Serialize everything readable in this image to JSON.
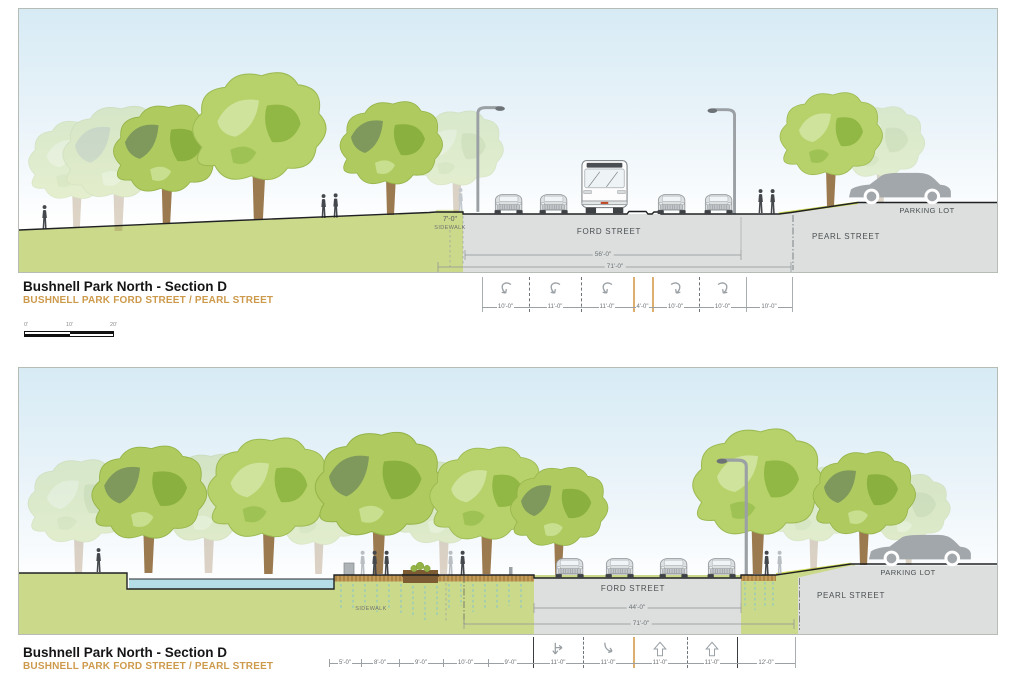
{
  "document": {
    "title": "Bushnell Park North - Section D",
    "subtitle": "BUSHNELL PARK FORD STREET / PEARL STREET"
  },
  "colors": {
    "sky_top": "#d7ebf5",
    "park_green": "#cbd98b",
    "road_gray": "#dcdfde",
    "water_blue": "#b5dde8",
    "soil_brown": "#c49a56",
    "subtitle_orange": "#cd9a4c",
    "lane_marker_orange": "#dcaf6e",
    "slope_highlight": "#cfd84f",
    "outline_dark": "#1f2123"
  },
  "scale_bar": {
    "labels": [
      "0'",
      "10'",
      "20'"
    ]
  },
  "sections": {
    "top": {
      "labels": {
        "sidewalk_width": "7'-0\"",
        "sidewalk": "SIDEWALK",
        "ford_street": "FORD STREET",
        "pearl_street": "PEARL STREET",
        "parking_lot": "PARKING LOT",
        "roadway_width": "56'-0\"",
        "overall_width": "71'-0\""
      },
      "lanes": [
        {
          "label": "10'-0\"",
          "arrow": "curl-left"
        },
        {
          "label": "11'-0\"",
          "arrow": "curl-left"
        },
        {
          "label": "11'-0\"",
          "arrow": "curl-left"
        },
        {
          "label": "4'-0\"",
          "arrow": null
        },
        {
          "label": "10'-0\"",
          "arrow": "curl-right"
        },
        {
          "label": "10'-0\"",
          "arrow": "curl-right"
        },
        {
          "label": "10'-0\"",
          "arrow": null
        }
      ]
    },
    "bottom": {
      "labels": {
        "sidewalk": "SIDEWALK",
        "ford_street": "FORD STREET",
        "pearl_street": "PEARL STREET",
        "parking_lot": "PARKING LOT",
        "roadway_width": "44'-0\"",
        "overall_width": "71'-0\""
      },
      "lanes": [
        {
          "label": "5'-0\"",
          "arrow": null
        },
        {
          "label": "8'-0\"",
          "arrow": null
        },
        {
          "label": "9'-0\"",
          "arrow": null
        },
        {
          "label": "10'-0\"",
          "arrow": null
        },
        {
          "label": "9'-0\"",
          "arrow": null
        },
        {
          "label": "11'-0\"",
          "arrow": "branch-right"
        },
        {
          "label": "11'-0\"",
          "arrow": "curve-right"
        },
        {
          "label": "11'-0\"",
          "arrow": "up"
        },
        {
          "label": "11'-0\"",
          "arrow": "up"
        },
        {
          "label": "12'-0\"",
          "arrow": null
        }
      ]
    }
  }
}
